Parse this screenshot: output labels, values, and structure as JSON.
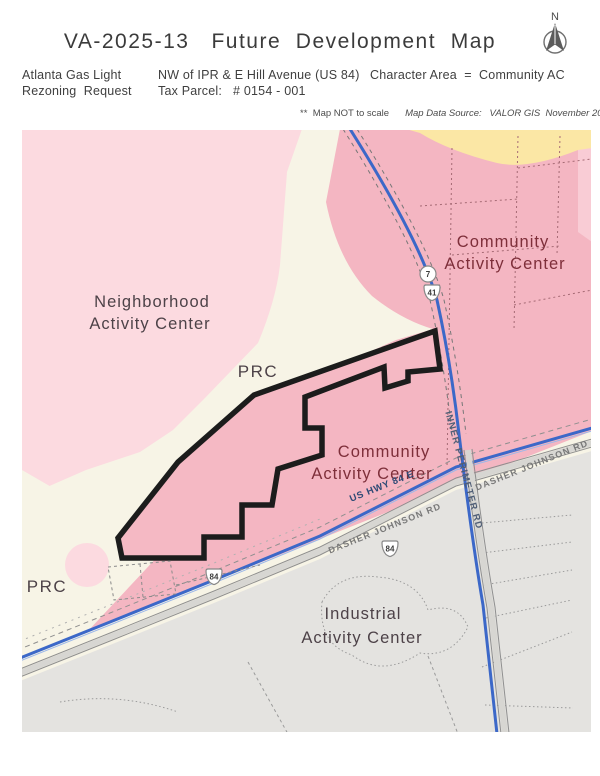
{
  "header": {
    "title": "VA-2025-13   Future  Development  Map",
    "applicant_line1": "Atlanta Gas Light",
    "applicant_line2": "Rezoning  Request",
    "location_line1": "NW of IPR & E Hill Avenue (US 84)",
    "location_line2": "Tax Parcel:   # 0154 - 001",
    "character_area": "Character Area  =  Community AC",
    "note_stars": "**",
    "note_scale": "Map NOT to scale",
    "note_source": "Map Data Source:   VALOR GIS  November 2025",
    "north_label": "N"
  },
  "map": {
    "labels": {
      "neighborhood_1": "Neighborhood",
      "neighborhood_2": "Activity Center",
      "prc_upper": "PRC",
      "prc_lower": "PRC",
      "community_right_1": "Community",
      "community_right_2": "Activity Center",
      "community_center_1": "Community",
      "community_center_2": "Activity Center",
      "industrial_1": "Industrial",
      "industrial_2": "Activity Center"
    },
    "roads": {
      "us_hwy": "US HWY 84 E",
      "dasher_left": "DASHER JOHNSON RD",
      "dasher_right": "DASHER JOHNSON RD",
      "inner_perimeter": "INNER PERIMETER RD"
    },
    "shields": {
      "route7": "7",
      "route41": "41",
      "route84_a": "84",
      "route84_b": "84"
    },
    "colors": {
      "neighborhood_pink": "#fcdae0",
      "community_pink": "#f4b6c2",
      "parcel_fill": "#f5b9c4",
      "prc_cream": "#f7f4e6",
      "industrial_gray": "#e4e3e0",
      "yellow_area": "#fbe7a5",
      "road_blue": "#3c68c8",
      "parcel_outline": "#1c1c1c",
      "community_label": "#7e2f3a",
      "area_label": "#4d4248"
    }
  }
}
